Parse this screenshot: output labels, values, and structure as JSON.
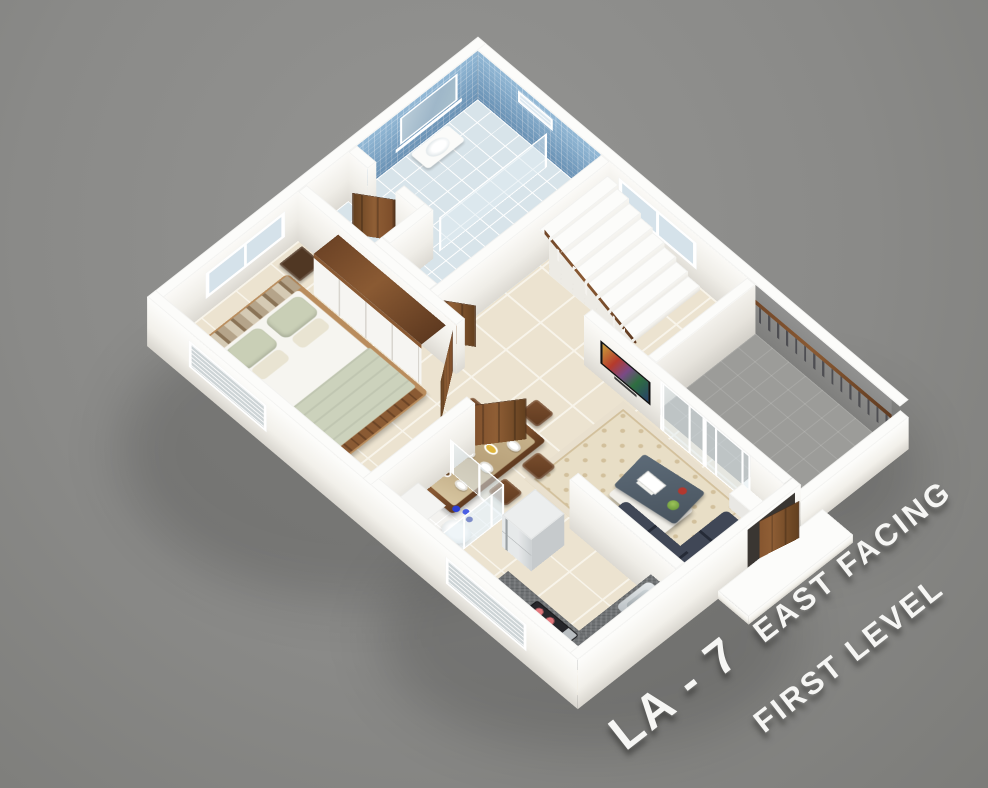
{
  "title": {
    "code": "LA - 7",
    "facing": "EAST FACING",
    "level": "FIRST LEVEL"
  },
  "colors": {
    "background": "#8a8a88",
    "background_light": "#949492",
    "background_dark": "#7c7c79",
    "building_shadow": "rgba(0,0,0,0.16)",
    "wall_top": "#fcfcfa",
    "wall_face": "#efede7",
    "floor_tile": "#ece3d0",
    "tile_grout": "#f8f4ea",
    "bathroom_tile": "#79a8cc",
    "bathroom_floor": "#d8e4ea",
    "balcony_floor": "#9c9c99",
    "balcony_wall": "#919190",
    "glass": "rgba(223,236,241,0.5)",
    "wood": "#8a5a33",
    "wood_dark": "#5f3a20",
    "wood_light": "#b98c5c",
    "door_wood": "#7b4c29",
    "sofa": "#323949",
    "sofa_dark": "#262c38",
    "rug": "#e8dec6",
    "rug_motif": "#d2c09c",
    "counter_granite": "#6f7274",
    "appliance_steel": "#c9cdcf",
    "stove": "#26262a",
    "burner": "#e0767b",
    "bed_blanket": "#ccd2bc",
    "bed_pillow": "#c9cfb6",
    "bed_sheet": "#f6f5f0",
    "nightstand": "#503723",
    "mirror": "#9fb7c9",
    "window_glass": "#d5e2ea",
    "doorway_dark": "#3a3632",
    "text": "#f6f6f4"
  }
}
